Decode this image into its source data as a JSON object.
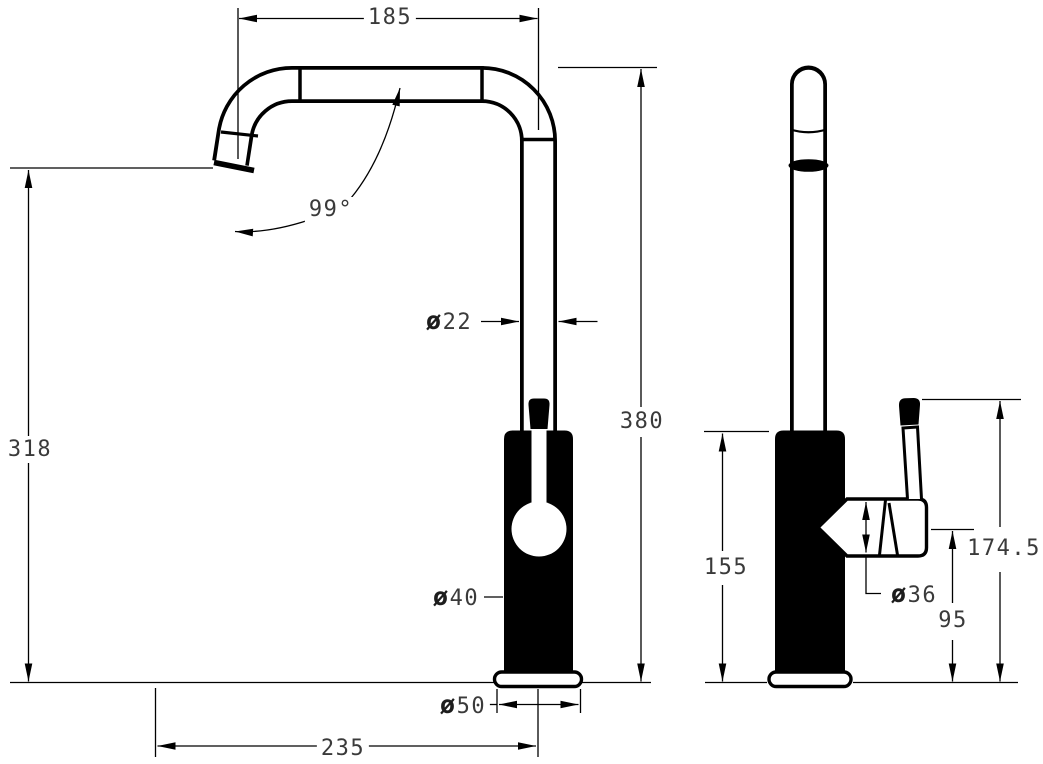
{
  "drawing": {
    "kind": "faucet dimensional drawing, front and side views",
    "colors": {
      "line": "#000000",
      "background": "#ffffff",
      "text": "#3a3a3a"
    }
  },
  "dimensions": {
    "spout_reach": "185",
    "spout_angle": "99°",
    "spout_tube_diameter": "ø22",
    "overall_height": "380",
    "spout_outlet_height": "318",
    "body_diameter": "ø40",
    "base_diameter": "ø50",
    "overall_reach": "235",
    "body_height": "155",
    "cartridge_diameter": "ø36",
    "handle_center_height": "95",
    "handle_top_height": "174.5"
  }
}
